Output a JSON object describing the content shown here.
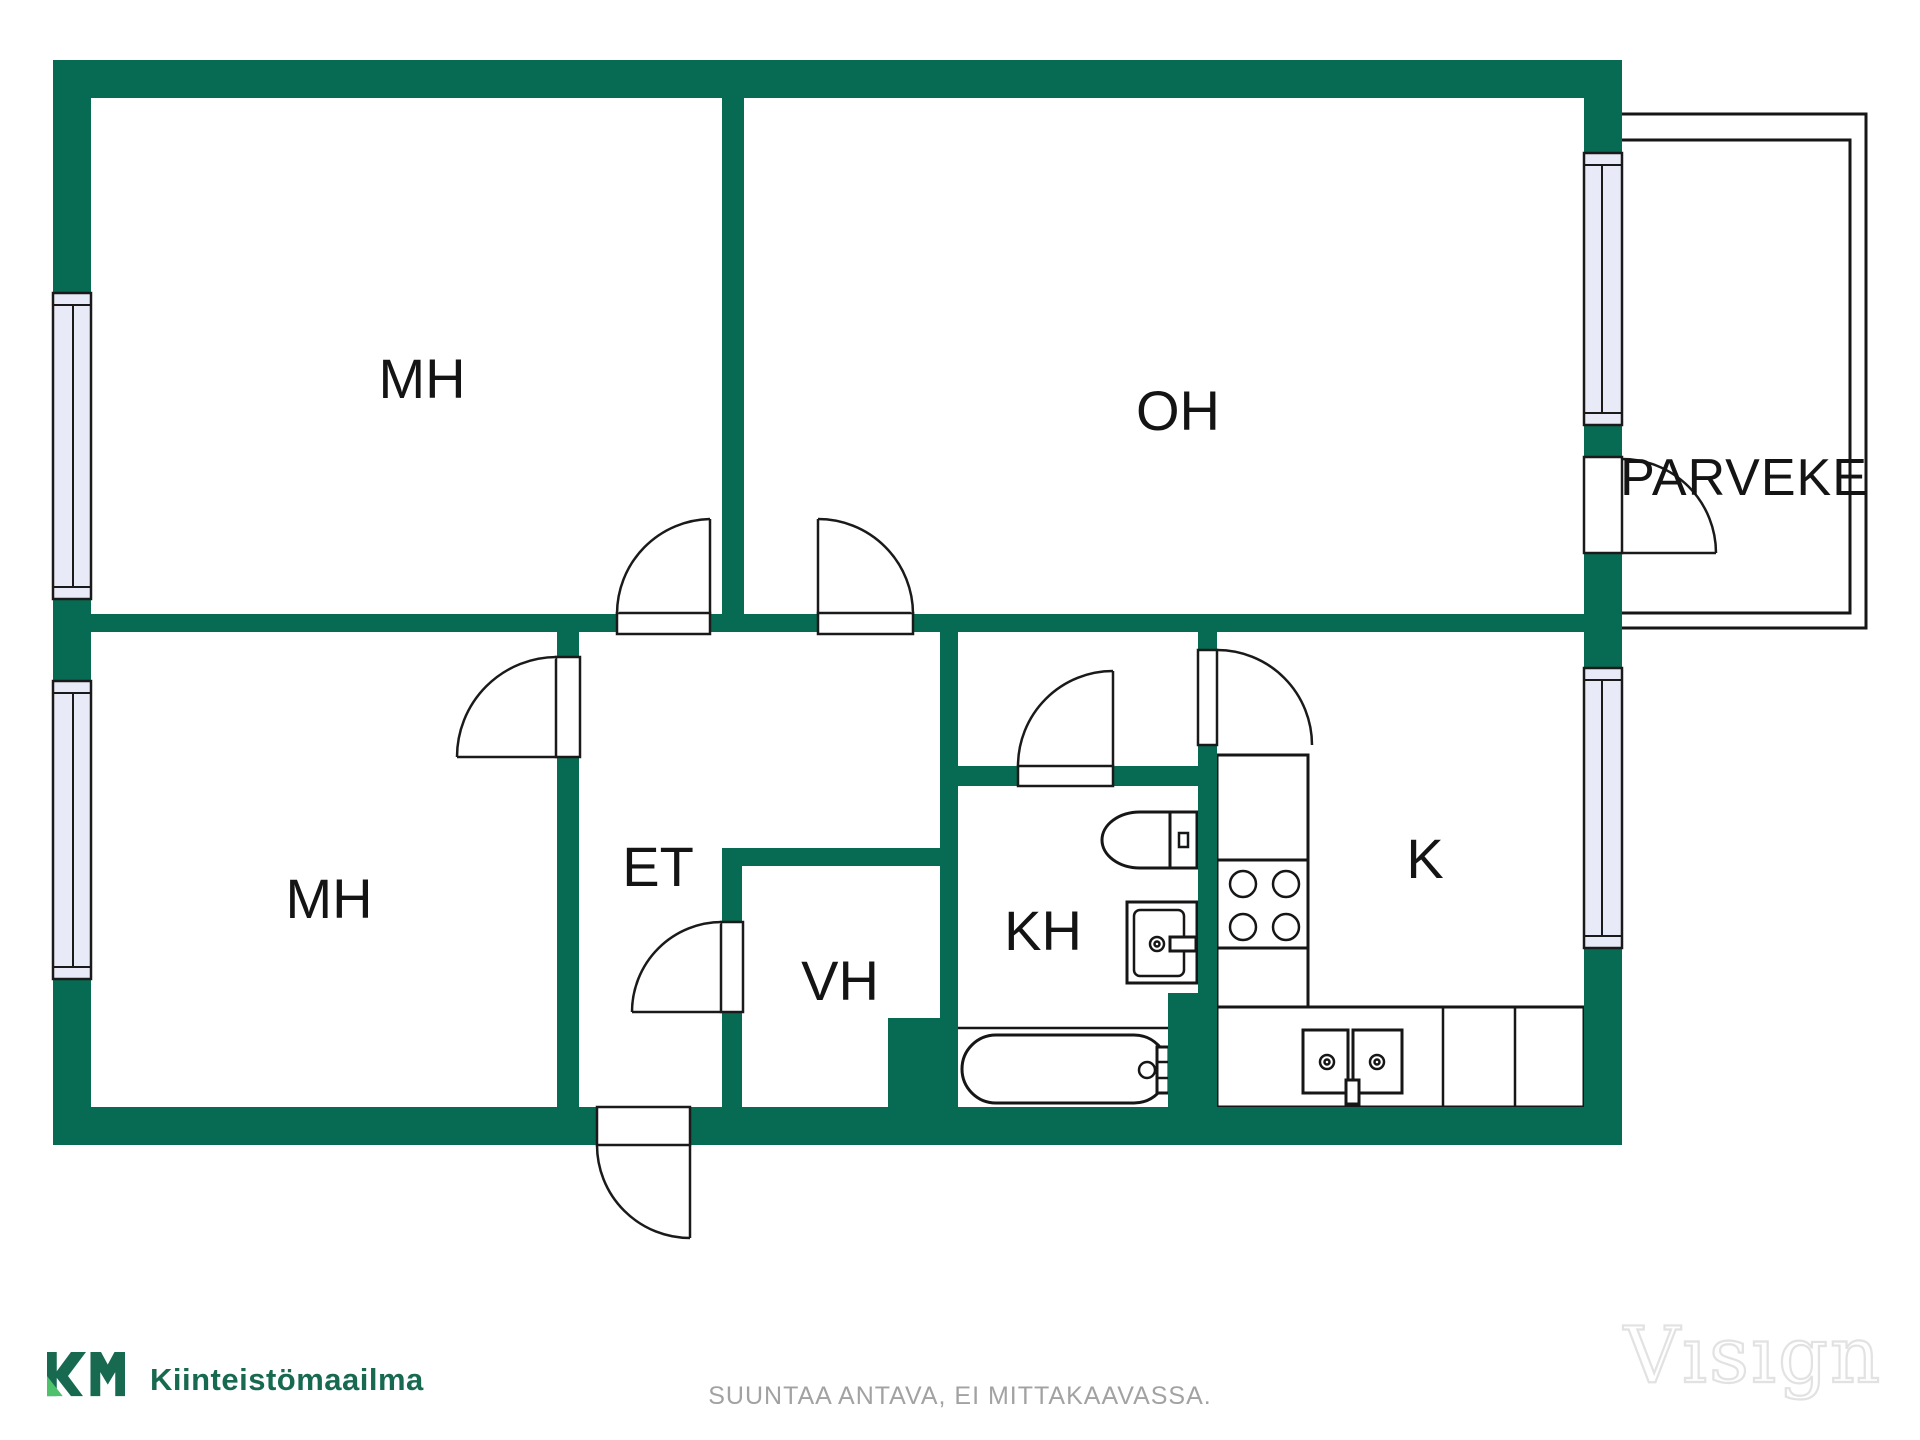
{
  "meta": {
    "title": "Floor plan",
    "canvas_width": 1920,
    "canvas_height": 1440
  },
  "colors": {
    "bg": "#FFFFFF",
    "wall": "#076A52",
    "window_fill": "#E9EAF7",
    "line": "#1A1A1A",
    "logo_dark": "#176A50",
    "logo_light": "#4EC16D",
    "footer_gray": "#A2A2A2",
    "watermark_stroke": "#E2E2E2"
  },
  "rooms": {
    "labels": [
      {
        "id": "mh-top",
        "text": "MH"
      },
      {
        "id": "oh",
        "text": "OH"
      },
      {
        "id": "parveke",
        "text": "PARVEKE"
      },
      {
        "id": "mh-bottom",
        "text": "MH"
      },
      {
        "id": "et",
        "text": "ET"
      },
      {
        "id": "vh",
        "text": "VH"
      },
      {
        "id": "kh",
        "text": "KH"
      },
      {
        "id": "k",
        "text": "K"
      }
    ]
  },
  "fixtures": [
    "toilet",
    "washbasin",
    "bathtub",
    "stove",
    "kitchen-sink",
    "kitchen-counter"
  ],
  "branding": {
    "logo_mark": "KM",
    "logo_text": "Kiinteistömaailma"
  },
  "footer": {
    "disclaimer": "SUUNTAA ANTAVA, EI MITTAKAAVASSA."
  },
  "watermark": {
    "text": "Vısıgn"
  }
}
